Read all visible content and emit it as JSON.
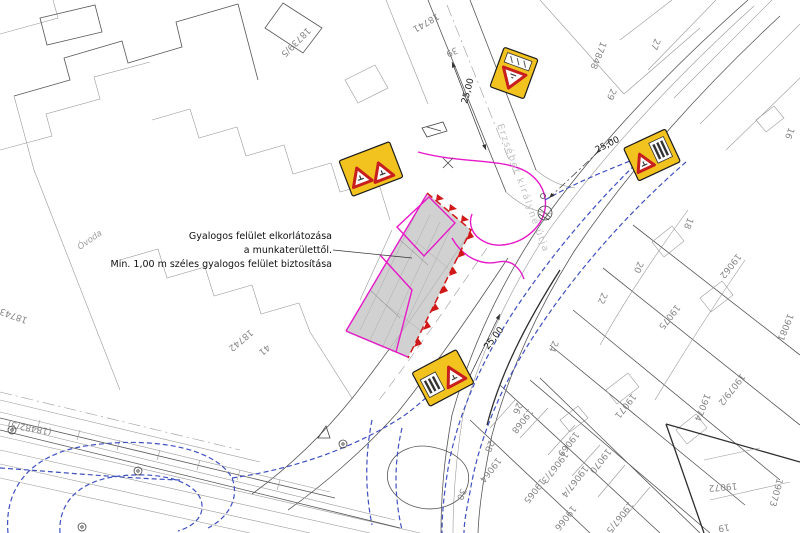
{
  "drawing": {
    "type": "traffic-management-site-plan",
    "language": "hu"
  },
  "annotation": {
    "line1": "Gyalogos  felület elkorlátozása",
    "line2": "a munkaterülettől.",
    "line3": "Min. 1,00 m széles gyalogos felület biztosítása"
  },
  "street_name": "Erzsébet királyné útja",
  "dimension_value": "25,00",
  "colors": {
    "sign_yellow": "#f2c31f",
    "sign_red": "#c81e1e",
    "work_zone_fill": "#c9c9c9",
    "boundary_magenta": "#e619c9",
    "route_blue": "#3f51c1",
    "barrier_red": "#d01818",
    "linework": "#565656",
    "label_gray": "#868686"
  },
  "signs": [
    {
      "name": "give-way-warning-sign",
      "icons": [
        "warning-triangle-icon",
        "supplementary-plate-icon"
      ]
    },
    {
      "name": "roadworks-double-warning-sign",
      "icons": [
        "warning-triangle-icon",
        "warning-triangle-icon"
      ]
    },
    {
      "name": "warning-sign-with-barrier-plate-right",
      "icons": [
        "warning-triangle-icon",
        "striped-barrier-plate-icon"
      ]
    },
    {
      "name": "warning-sign-with-barrier-plate-bottom",
      "icons": [
        "striped-barrier-plate-icon",
        "warning-triangle-icon"
      ]
    }
  ],
  "labels": [
    {
      "text": "Gyalogos  felület elkorlátozása",
      "x": 332,
      "y": 239,
      "rot": 0,
      "cls": "note",
      "anchor": "end",
      "name": "note-line-1"
    },
    {
      "text": "a munkaterülettől.",
      "x": 332,
      "y": 253,
      "rot": 0,
      "cls": "note",
      "anchor": "end",
      "name": "note-line-2"
    },
    {
      "text": "Min. 1,00 m széles gyalogos felület biztosítása",
      "x": 332,
      "y": 267,
      "rot": 0,
      "cls": "note",
      "anchor": "end",
      "name": "note-line-3"
    },
    {
      "text": "25,00",
      "x": 467,
      "y": 104,
      "rot": -75,
      "cls": "dim",
      "name": "dimension-label"
    },
    {
      "text": "25,00",
      "x": 597,
      "y": 153,
      "rot": -27,
      "cls": "dim",
      "name": "dimension-label"
    },
    {
      "text": "25,00",
      "x": 488,
      "y": 350,
      "rot": -52,
      "cls": "dim",
      "name": "dimension-label"
    },
    {
      "text": "Erzsébet királyné útja",
      "x": 497,
      "y": 125,
      "rot": 70,
      "cls": "street",
      "name": "street-name-label"
    },
    {
      "text": "Óvoda",
      "x": 80,
      "y": 250,
      "rot": -35,
      "cls": "poi",
      "name": "poi-label"
    },
    {
      "text": "18739/5",
      "x": 307,
      "y": 27,
      "rot": 135,
      "cls": "parcel",
      "name": "parcel-label"
    },
    {
      "text": "18741",
      "x": 437,
      "y": 13,
      "rot": 150,
      "cls": "parcel",
      "name": "parcel-label"
    },
    {
      "text": "39",
      "x": 456,
      "y": 47,
      "rot": 155,
      "cls": "parcel",
      "name": "parcel-label"
    },
    {
      "text": "17848",
      "x": 601,
      "y": 41,
      "rot": 112,
      "cls": "parcel",
      "name": "parcel-label"
    },
    {
      "text": "27",
      "x": 655,
      "y": 38,
      "rot": 112,
      "cls": "parcel",
      "name": "parcel-label"
    },
    {
      "text": "29",
      "x": 611,
      "y": 88,
      "rot": 112,
      "cls": "parcel",
      "name": "parcel-label"
    },
    {
      "text": "16",
      "x": 789,
      "y": 127,
      "rot": 112,
      "cls": "parcel",
      "name": "parcel-label"
    },
    {
      "text": "18",
      "x": 688,
      "y": 217,
      "rot": 112,
      "cls": "parcel",
      "name": "parcel-label"
    },
    {
      "text": "20",
      "x": 638,
      "y": 261,
      "rot": 112,
      "cls": "parcel",
      "name": "parcel-label"
    },
    {
      "text": "22",
      "x": 602,
      "y": 292,
      "rot": 112,
      "cls": "parcel",
      "name": "parcel-label"
    },
    {
      "text": "24",
      "x": 553,
      "y": 340,
      "rot": 112,
      "cls": "parcel",
      "name": "parcel-label"
    },
    {
      "text": "26",
      "x": 517,
      "y": 402,
      "rot": 112,
      "cls": "parcel",
      "name": "parcel-label"
    },
    {
      "text": "28",
      "x": 489,
      "y": 440,
      "rot": 112,
      "cls": "parcel",
      "name": "parcel-label"
    },
    {
      "text": "30",
      "x": 461,
      "y": 488,
      "rot": 112,
      "cls": "parcel",
      "name": "parcel-label"
    },
    {
      "text": "18743",
      "x": 28,
      "y": 318,
      "rot": 200,
      "cls": "parcel",
      "name": "parcel-label"
    },
    {
      "text": "18742",
      "x": 250,
      "y": 329,
      "rot": 140,
      "cls": "parcel",
      "name": "parcel-label"
    },
    {
      "text": "41",
      "x": 267,
      "y": 344,
      "rot": 140,
      "cls": "parcel",
      "name": "parcel-label"
    },
    {
      "text": "(18482/3)",
      "x": 52,
      "y": 429,
      "rot": 190,
      "cls": "parcel",
      "name": "parcel-label"
    },
    {
      "text": "19062",
      "x": 737,
      "y": 253,
      "rot": 128,
      "cls": "parcel",
      "name": "parcel-label"
    },
    {
      "text": "19075",
      "x": 676,
      "y": 304,
      "rot": 128,
      "cls": "parcel",
      "name": "parcel-label"
    },
    {
      "text": "19081",
      "x": 788,
      "y": 313,
      "rot": 112,
      "cls": "parcel",
      "name": "parcel-label"
    },
    {
      "text": "19079/2",
      "x": 741,
      "y": 373,
      "rot": 128,
      "cls": "parcel",
      "name": "parcel-label"
    },
    {
      "text": "19074",
      "x": 705,
      "y": 393,
      "rot": 112,
      "cls": "parcel",
      "name": "parcel-label"
    },
    {
      "text": "19071",
      "x": 632,
      "y": 393,
      "rot": 128,
      "cls": "parcel",
      "name": "parcel-label"
    },
    {
      "text": "19070",
      "x": 607,
      "y": 448,
      "rot": 128,
      "cls": "parcel",
      "name": "parcel-label"
    },
    {
      "text": "19068",
      "x": 529,
      "y": 408,
      "rot": 128,
      "cls": "parcel",
      "name": "parcel-label"
    },
    {
      "text": "19069",
      "x": 575,
      "y": 431,
      "rot": 128,
      "cls": "parcel",
      "name": "parcel-label"
    },
    {
      "text": "19067/3",
      "x": 564,
      "y": 451,
      "rot": 128,
      "cls": "parcel",
      "name": "parcel-label"
    },
    {
      "text": "19067/4",
      "x": 584,
      "y": 465,
      "rot": 128,
      "cls": "parcel",
      "name": "parcel-label"
    },
    {
      "text": "19064",
      "x": 497,
      "y": 457,
      "rot": 128,
      "cls": "parcel",
      "name": "parcel-label"
    },
    {
      "text": "19065",
      "x": 541,
      "y": 478,
      "rot": 128,
      "cls": "parcel",
      "name": "parcel-label"
    },
    {
      "text": "19066",
      "x": 572,
      "y": 505,
      "rot": 128,
      "cls": "parcel",
      "name": "parcel-label"
    },
    {
      "text": "19067/5",
      "x": 629,
      "y": 501,
      "rot": 128,
      "cls": "parcel",
      "name": "parcel-label"
    },
    {
      "text": "19072",
      "x": 737,
      "y": 483,
      "rot": 175,
      "cls": "parcel",
      "name": "parcel-label"
    },
    {
      "text": "19073",
      "x": 777,
      "y": 478,
      "rot": 105,
      "cls": "parcel",
      "name": "parcel-label"
    },
    {
      "text": "19",
      "x": 729,
      "y": 524,
      "rot": 170,
      "cls": "parcel",
      "name": "parcel-label"
    }
  ]
}
